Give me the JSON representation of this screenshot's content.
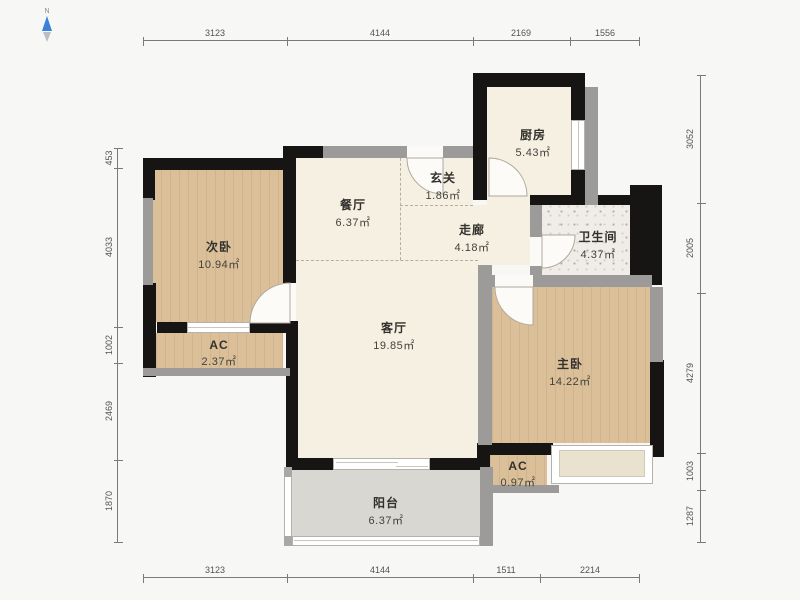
{
  "compass": {
    "label": "N"
  },
  "rooms": [
    {
      "id": "second-bedroom",
      "name": "次卧",
      "area": "10.94㎡"
    },
    {
      "id": "dining",
      "name": "餐厅",
      "area": "6.37㎡"
    },
    {
      "id": "entry",
      "name": "玄关",
      "area": "1.86㎡"
    },
    {
      "id": "kitchen",
      "name": "厨房",
      "area": "5.43㎡"
    },
    {
      "id": "corridor",
      "name": "走廊",
      "area": "4.18㎡"
    },
    {
      "id": "bathroom",
      "name": "卫生间",
      "area": "4.37㎡"
    },
    {
      "id": "living",
      "name": "客厅",
      "area": "19.85㎡"
    },
    {
      "id": "master-bedroom",
      "name": "主卧",
      "area": "14.22㎡"
    },
    {
      "id": "ac-left",
      "name": "AC",
      "area": "2.37㎡"
    },
    {
      "id": "ac-right",
      "name": "AC",
      "area": "0.97㎡"
    },
    {
      "id": "balcony",
      "name": "阳台",
      "area": "6.37㎡"
    }
  ],
  "dimensions": {
    "top": [
      "3123",
      "4144",
      "2169",
      "1556"
    ],
    "bottom": [
      "3123",
      "4144",
      "1511",
      "2214"
    ],
    "left": [
      "453",
      "4033",
      "1002",
      "2469",
      "1870"
    ],
    "right": [
      "3052",
      "2005",
      "4279",
      "1003",
      "1287"
    ]
  },
  "colors": {
    "wall_black": "#171513",
    "wall_gray": "#9c9b99",
    "floor_wood": "#dabf99",
    "floor_cream": "#f6f0e2",
    "floor_tile": "#f0ede9",
    "floor_balcony": "#d9d7d2",
    "bay_window": "#e9e2cf",
    "compass_blue": "#3b82d8"
  }
}
